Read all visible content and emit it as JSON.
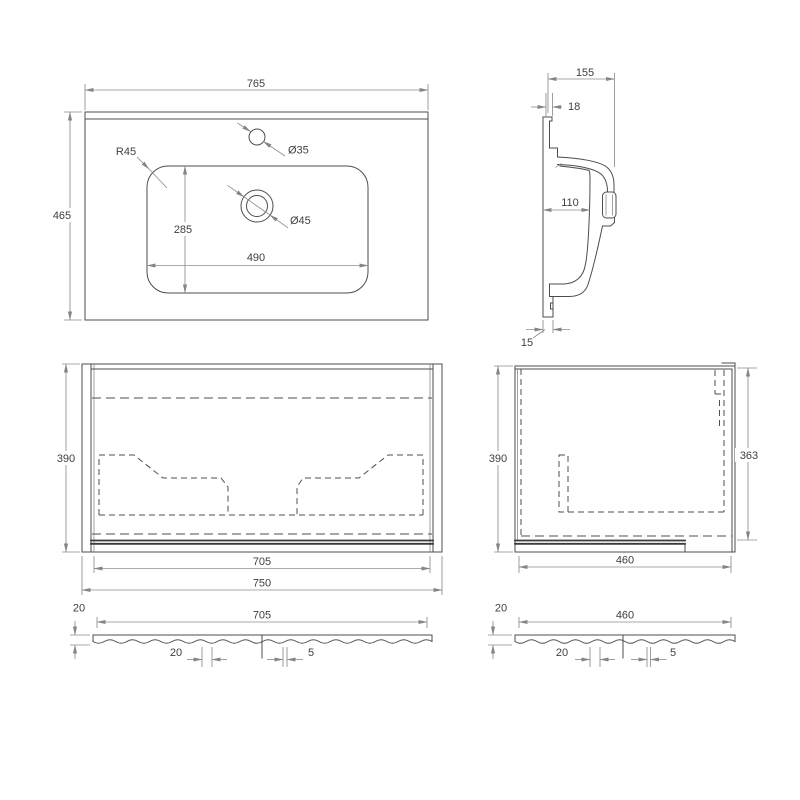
{
  "document": {
    "type": "technical-drawing",
    "subject": "washbasin-and-vanity-cabinet"
  },
  "colors": {
    "background": "#ffffff",
    "geometry_line": "#4d4d4d",
    "dimension_line": "#8e8e8e",
    "text": "#3f3f3f"
  },
  "views": {
    "basin_top": {
      "label": "basin-top-view",
      "width": "765",
      "depth": "465",
      "corner_radius": "R45",
      "faucet_hole": "Ø35",
      "drain_hole": "Ø45",
      "bowl_depth": "285",
      "bowl_width": "490"
    },
    "basin_section": {
      "label": "basin-section-view",
      "depth": "155",
      "rim_thickness": "18",
      "bowl_inner": "110",
      "wall_thickness": "15"
    },
    "cabinet_front": {
      "label": "cabinet-front-view",
      "height": "390",
      "inner_width": "705",
      "width": "750"
    },
    "cabinet_side": {
      "label": "cabinet-side-view",
      "height": "390",
      "inner_height": "363",
      "depth": "460"
    },
    "front_panel_section": {
      "label": "front-panel-section-view",
      "thickness": "20",
      "width": "705",
      "groove_offset": "20",
      "groove_width": "5"
    },
    "side_panel_section": {
      "label": "side-panel-section-view",
      "thickness": "20",
      "width": "460",
      "groove_offset": "20",
      "groove_width": "5"
    }
  }
}
